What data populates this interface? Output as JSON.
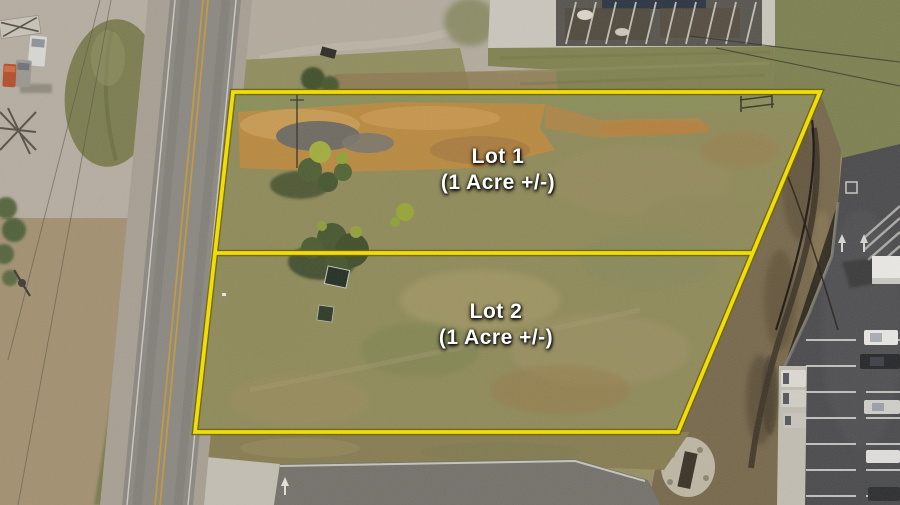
{
  "overlay": {
    "lot1": {
      "title": "Lot 1",
      "acreage": "(1 Acre +/-)"
    },
    "lot2": {
      "title": "Lot 2",
      "acreage": "(1 Acre +/-)"
    }
  },
  "colors": {
    "boundary_line": "#F3DF01",
    "boundary_outline": "#6B5E00",
    "label_text": "#FFFFFF"
  }
}
